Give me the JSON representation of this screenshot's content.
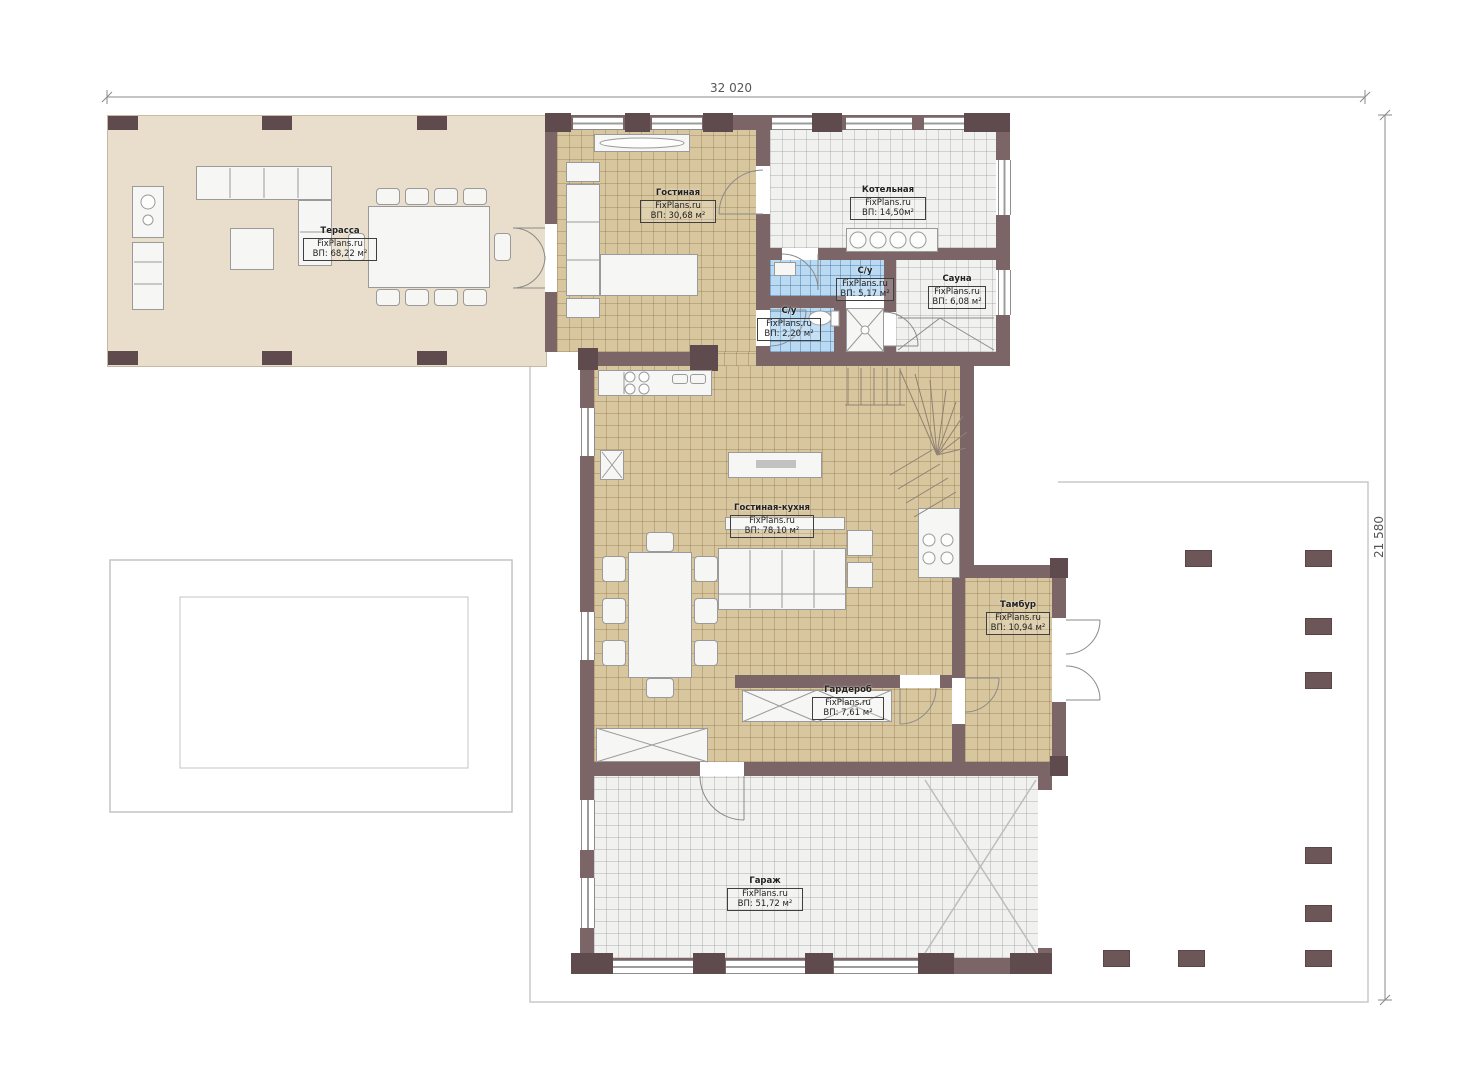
{
  "document": {
    "kind": "floor-plan",
    "floor": "first"
  },
  "branding": {
    "site": "FixPlans.ru"
  },
  "dimensions": {
    "width_label": "32 020",
    "height_label": "21 580"
  },
  "rooms": {
    "terrace": {
      "name": "Терасса",
      "site": "FixPlans.ru",
      "area": "ВП: 68,22 м²"
    },
    "living": {
      "name": "Гостиная",
      "site": "FixPlans.ru",
      "area": "ВП: 30,68 м²"
    },
    "boiler": {
      "name": "Котельная",
      "site": "FixPlans.ru",
      "area": "ВП: 14,50м²"
    },
    "bath1": {
      "name": "С/у",
      "site": "FixPlans.ru",
      "area": "ВП: 5,17 м²"
    },
    "bath2": {
      "name": "С/у",
      "site": "FixPlans.ru",
      "area": "ВП: 2,20 м²"
    },
    "sauna": {
      "name": "Сауна",
      "site": "FixPlans.ru",
      "area": "ВП: 6,08 м²"
    },
    "kitchen_living": {
      "name": "Гостиная-кухня",
      "site": "FixPlans.ru",
      "area": "ВП: 78,10 м²"
    },
    "vestibule": {
      "name": "Тамбур",
      "site": "FixPlans.ru",
      "area": "ВП: 10,94 м²"
    },
    "wardrobe": {
      "name": "Гардероб",
      "site": "FixPlans.ru",
      "area": "ВП: 7,61 м²"
    },
    "garage": {
      "name": "Гараж",
      "site": "FixPlans.ru",
      "area": "ВП: 51,72 м²"
    }
  },
  "colors": {
    "wall": "#7b6567",
    "column": "#5f4b4d",
    "terrace_floor": "#e9decb",
    "tile_tan": "#d8c69e",
    "tile_gray": "#f1f1f0",
    "tile_blue": "#b9daf2",
    "outline": "#c9c9c9"
  }
}
